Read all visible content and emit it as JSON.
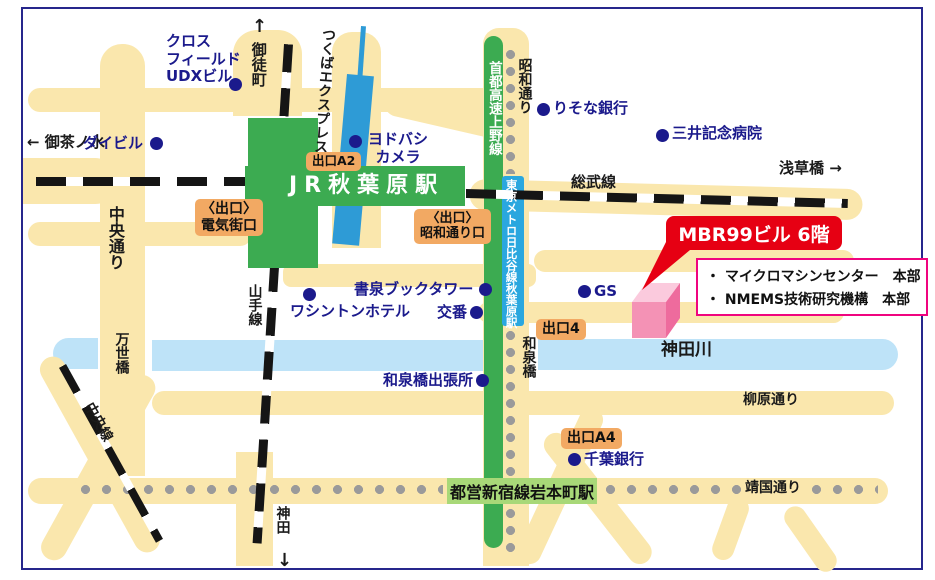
{
  "map": {
    "frame_color": "#26268C",
    "colors": {
      "road": "#FAE7AD",
      "river": "#BEE3F8",
      "rail_black": "#151515",
      "station_green": "#3CAB51",
      "toei_badge_green": "#A8D878",
      "metro_strip_blue": "#2AA7DF",
      "tsukuba_express_blue": "#2E9BD6",
      "metro_dots_gray": "#9A9A9A",
      "poi_blue": "#1B1A8C",
      "exit_badge_orange": "#F2A963",
      "callout_red": "#E60013",
      "info_border_pink": "#F0047F",
      "building_pink": "#F492B5"
    },
    "stations": {
      "jr": "JR秋葉原駅",
      "toei": "都営新宿線岩本町駅"
    },
    "callout": {
      "title": "MBR99ビル 6階"
    },
    "info_box": {
      "items": [
        "・ マイクロマシンセンター　本部",
        "・ NMEMS技術研究機構　本部"
      ]
    },
    "building": {
      "name": "MBR99ビル"
    },
    "labels": [
      {
        "n": "label-okachimachi-arrow",
        "t": "↑",
        "x": 252,
        "y": 16,
        "c": "blk",
        "fs": 18
      },
      {
        "n": "label-okachimachi",
        "t": "御徒町",
        "x": 249,
        "y": 42,
        "c": "vert",
        "fs": 15
      },
      {
        "n": "label-tsukuba-express",
        "t": "つくばエクスプレス",
        "x": 320,
        "y": 27,
        "c": "vert",
        "fs": 14,
        "r": 4
      },
      {
        "n": "label-ochanomizu",
        "t": "← 御茶ノ水",
        "x": 27,
        "y": 134,
        "c": "blk",
        "fs": 15
      },
      {
        "n": "label-asakusabashi",
        "t": "浅草橋 →",
        "x": 779,
        "y": 160,
        "c": "blk",
        "fs": 15
      },
      {
        "n": "label-sobu-line",
        "t": "総武線",
        "x": 571,
        "y": 174,
        "c": "blk",
        "fs": 15
      },
      {
        "n": "label-showa-dori",
        "t": "昭和通り",
        "x": 516,
        "y": 58,
        "c": "vert",
        "fs": 14
      },
      {
        "n": "label-shuto-expressway",
        "t": "首都高速上野線",
        "x": 485,
        "y": 61,
        "c": "wvert",
        "fs": 13.5
      },
      {
        "n": "label-metro-hibiya-akihabara",
        "t": "東京メトロ日比谷線秋葉原駅",
        "x": 504,
        "y": 179,
        "c": "wvert",
        "fs": 11.5
      },
      {
        "n": "label-chuo-dori",
        "t": "中央通り",
        "x": 105,
        "y": 206,
        "c": "vert",
        "fs": 16
      },
      {
        "n": "label-manseibashi",
        "t": "万世橋",
        "x": 113,
        "y": 332,
        "c": "vert",
        "fs": 14
      },
      {
        "n": "label-chuo-line",
        "t": "中央線",
        "x": 95,
        "y": 400,
        "c": "blk",
        "fs": 14,
        "r": 61
      },
      {
        "n": "label-yamanote-line",
        "t": "山手線",
        "x": 246,
        "y": 284,
        "c": "vert",
        "fs": 14
      },
      {
        "n": "label-kanda",
        "t": "神田",
        "x": 274,
        "y": 506,
        "c": "vert",
        "fs": 14
      },
      {
        "n": "label-kanda-arrow",
        "t": "↓",
        "x": 277,
        "y": 550,
        "c": "blk",
        "fs": 18
      },
      {
        "n": "label-izumibashi",
        "t": "和泉橋",
        "x": 520,
        "y": 336,
        "c": "vert",
        "fs": 14
      },
      {
        "n": "label-kanda-river",
        "t": "神田川",
        "x": 661,
        "y": 340,
        "c": "blk",
        "fs": 17
      },
      {
        "n": "label-yanagihara-dori",
        "t": "柳原通り",
        "x": 743,
        "y": 392,
        "c": "blk",
        "fs": 14
      },
      {
        "n": "label-yasukuni-dori",
        "t": "靖国通り",
        "x": 745,
        "y": 480,
        "c": "blk",
        "fs": 14
      },
      {
        "n": "poi-crossfield-udx",
        "t": "クロス\nフィールド\nUDXビル",
        "x": 166,
        "y": 33,
        "c": "poi"
      },
      {
        "n": "poi-daibiru",
        "t": "ダイビル",
        "x": 83,
        "y": 135,
        "c": "poi"
      },
      {
        "n": "poi-yodobashi-camera",
        "t": "ヨドバシ\nカメラ",
        "x": 366,
        "y": 131,
        "c": "poi",
        "w": 64,
        "ta": "center"
      },
      {
        "n": "poi-risona-bank",
        "t": "りそな銀行",
        "x": 553,
        "y": 100,
        "c": "poi"
      },
      {
        "n": "poi-mitsui-hospital",
        "t": "三井記念病院",
        "x": 672,
        "y": 125,
        "c": "poi"
      },
      {
        "n": "poi-shosen-book-tower",
        "t": "書泉ブックタワー",
        "x": 354,
        "y": 281,
        "c": "poi"
      },
      {
        "n": "poi-washington-hotel",
        "t": "ワシントンホテル",
        "x": 290,
        "y": 303,
        "c": "poi"
      },
      {
        "n": "poi-koban",
        "t": "交番",
        "x": 437,
        "y": 304,
        "c": "poi"
      },
      {
        "n": "poi-gs",
        "t": "GS",
        "x": 594,
        "y": 283,
        "c": "poi"
      },
      {
        "n": "poi-izumibashi-office",
        "t": "和泉橋出張所",
        "x": 383,
        "y": 372,
        "c": "poi"
      },
      {
        "n": "poi-chiba-bank",
        "t": "千葉銀行",
        "x": 584,
        "y": 451,
        "c": "poi"
      },
      {
        "n": "badge-exit-a2",
        "t": "出口A2",
        "x": 306,
        "y": 152,
        "c": "badge",
        "fs": 12.5
      },
      {
        "n": "badge-exit-denkigai",
        "t": "〈出口〉\n電気街口",
        "x": 195,
        "y": 199,
        "c": "badge",
        "fs": 14
      },
      {
        "n": "badge-exit-showadori",
        "t": "〈出口〉\n昭和通り口",
        "x": 414,
        "y": 209,
        "c": "badge",
        "fs": 13
      },
      {
        "n": "badge-exit-4",
        "t": "出口4",
        "x": 536,
        "y": 319,
        "c": "badge",
        "fs": 14
      },
      {
        "n": "badge-exit-a4",
        "t": "出口A4",
        "x": 561,
        "y": 428,
        "c": "badge",
        "fs": 14
      }
    ],
    "poi_dots": [
      [
        229,
        78
      ],
      [
        150,
        137
      ],
      [
        349,
        135
      ],
      [
        537,
        103
      ],
      [
        656,
        129
      ],
      [
        479,
        283
      ],
      [
        303,
        288
      ],
      [
        470,
        306
      ],
      [
        578,
        285
      ],
      [
        476,
        374
      ],
      [
        568,
        453
      ]
    ]
  }
}
